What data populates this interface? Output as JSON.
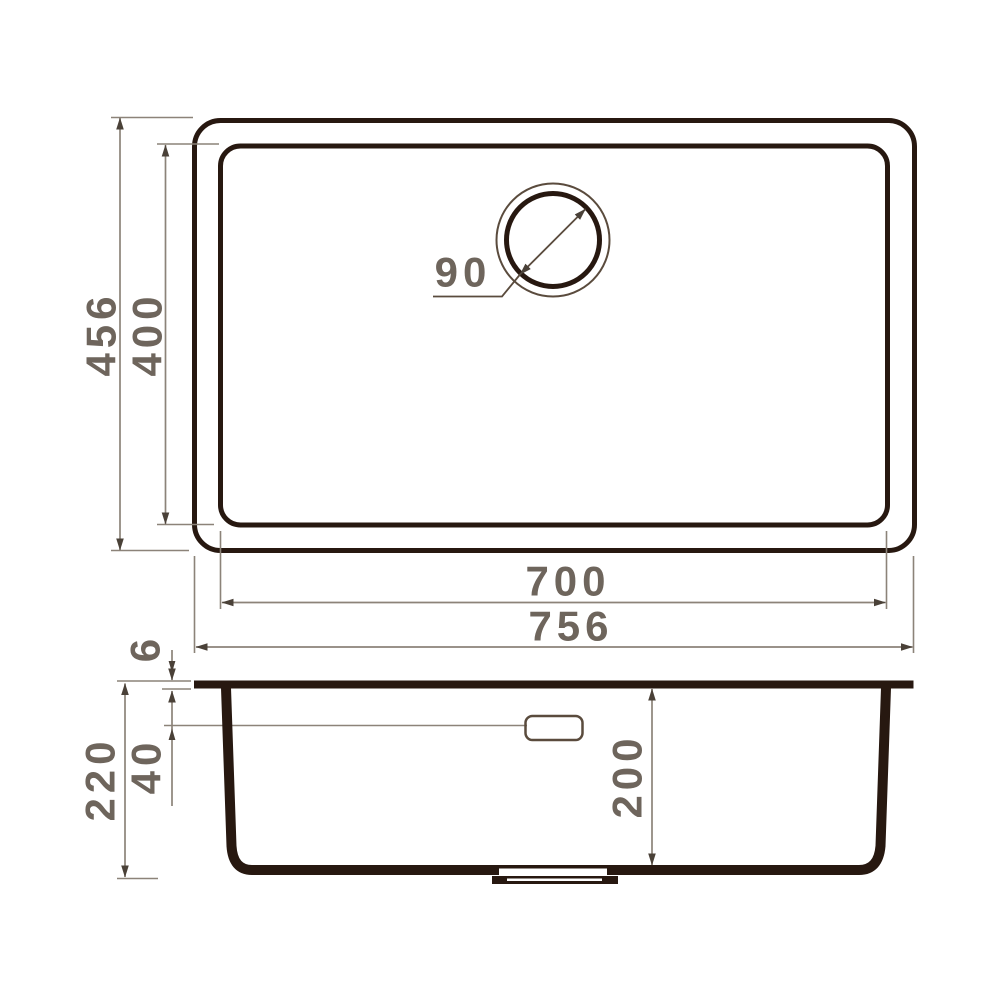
{
  "drawing": {
    "kind": "sink-technical-drawing",
    "views": {
      "top_view_label": "plan view of sink",
      "section_view_label": "side section of sink"
    },
    "dimensions": {
      "overall_width": "756",
      "bowl_width": "700",
      "overall_depth": "456",
      "bowl_depth": "400",
      "drain_diameter": "90",
      "rim_thickness": "6",
      "overflow_offset": "40",
      "overall_height": "220",
      "bowl_height": "200"
    },
    "colors": {
      "outline_dark": "#271810",
      "dimension_line": "#8c8379",
      "dimension_text": "#6e655c",
      "arrowhead": "#4a4138",
      "detail_brown": "#5a4b3d",
      "background": "#ffffff"
    }
  }
}
